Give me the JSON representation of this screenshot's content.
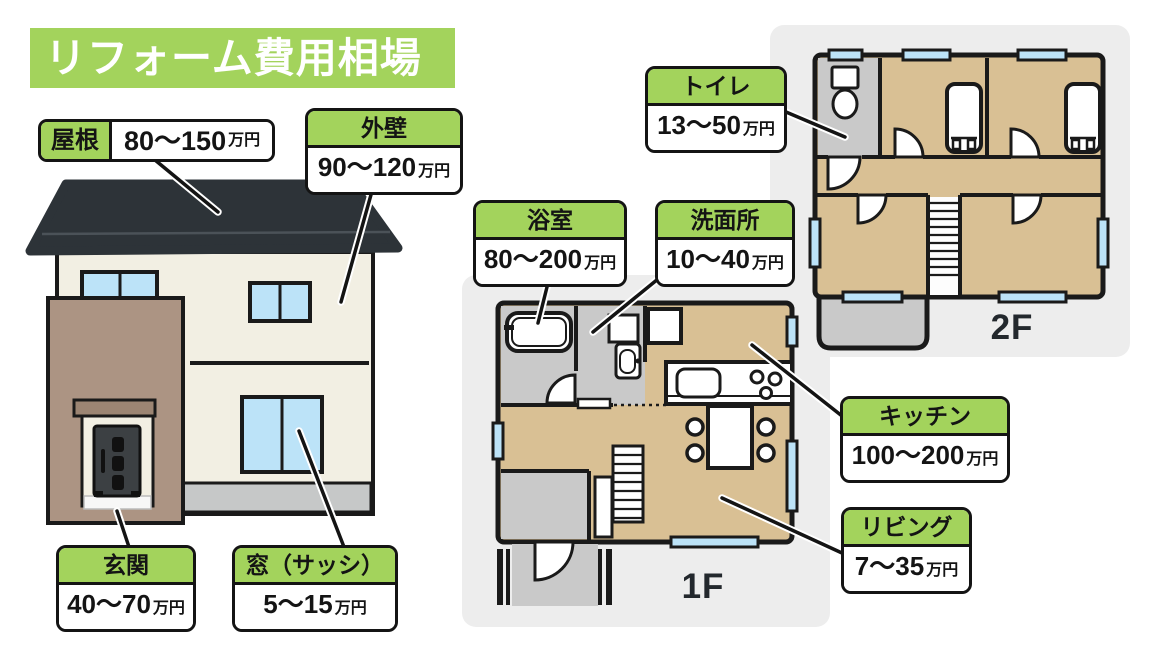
{
  "title": "リフォーム費用相場",
  "colors": {
    "accent_green": "#a3d35c",
    "label_border": "#141414",
    "room_tan": "#d9c094",
    "utility_gray": "#c9c9c9",
    "panel_gray": "#ededed",
    "window_blue": "#bce3f8",
    "roof_dark": "#2d3338",
    "wall_cream": "#f2efe3",
    "entrance_brown": "#ac9483"
  },
  "cost_labels": {
    "roof": {
      "name": "屋根",
      "range": "80〜150",
      "unit": "万円"
    },
    "exterior_wall": {
      "name": "外壁",
      "range": "90〜120",
      "unit": "万円"
    },
    "toilet": {
      "name": "トイレ",
      "range": "13〜50",
      "unit": "万円"
    },
    "bathroom": {
      "name": "浴室",
      "range": "80〜200",
      "unit": "万円"
    },
    "washroom": {
      "name": "洗面所",
      "range": "10〜40",
      "unit": "万円"
    },
    "kitchen": {
      "name": "キッチン",
      "range": "100〜200",
      "unit": "万円"
    },
    "living": {
      "name": "リビング",
      "range": "7〜35",
      "unit": "万円"
    },
    "entrance": {
      "name": "玄関",
      "range": "40〜70",
      "unit": "万円"
    },
    "window": {
      "name": "窓（サッシ）",
      "range": "5〜15",
      "unit": "万円"
    }
  },
  "floor_labels": {
    "first": "1F",
    "second": "2F"
  }
}
